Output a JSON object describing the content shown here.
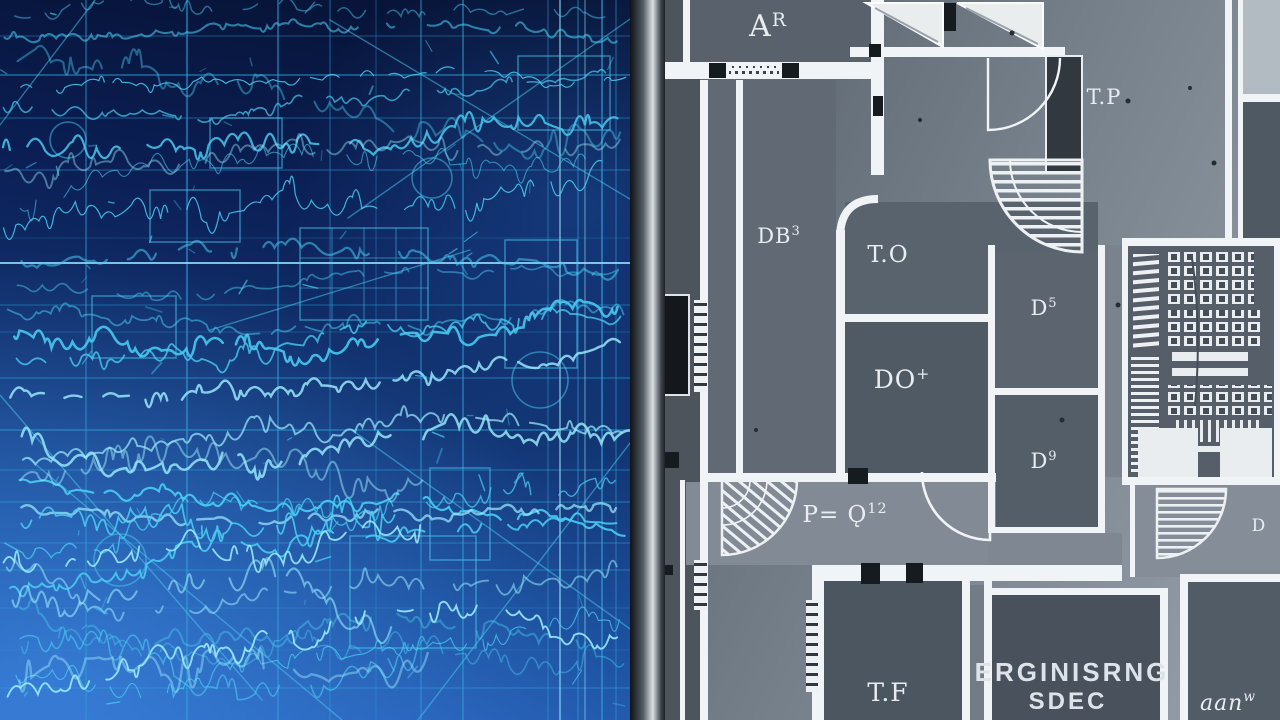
{
  "floorplan": {
    "labels": [
      {
        "text": "A",
        "sup": "R",
        "x": 768,
        "y": 36,
        "size": 30
      },
      {
        "text": "T.P",
        "sup": "",
        "x": 1104,
        "y": 104,
        "size": 21
      },
      {
        "text": "DB",
        "sup": "3",
        "x": 779,
        "y": 243,
        "size": 21
      },
      {
        "text": "T.O",
        "sup": "",
        "x": 888,
        "y": 262,
        "size": 23
      },
      {
        "text": "DO",
        "sup": "+",
        "x": 902,
        "y": 388,
        "size": 25
      },
      {
        "text": "D",
        "sup": "5",
        "x": 1044,
        "y": 315,
        "size": 21
      },
      {
        "text": "D",
        "sup": "9",
        "x": 1044,
        "y": 468,
        "size": 21
      },
      {
        "text": "P= Ǫ",
        "sup": "12",
        "x": 845,
        "y": 522,
        "size": 23
      },
      {
        "text": "T.F",
        "sup": "",
        "x": 888,
        "y": 701,
        "size": 25
      },
      {
        "text": "D",
        "sup": "",
        "x": 1259,
        "y": 531,
        "size": 17
      },
      {
        "text": "aan",
        "sup": "w",
        "x": 1228,
        "y": 710,
        "size": 22
      }
    ],
    "spec_label": {
      "line1": "ERGINISRNG",
      "line2": "SDEC"
    }
  },
  "colors": {
    "blueprint_ink": "#49cdf4",
    "blueprint_ink_bright": "#9aeafd",
    "blueprint_grid": "#2f9fd8",
    "plan_wall": "#f1f4f7",
    "plan_room_dark": "#4e5862",
    "window_symbol": "#161b20",
    "label_ink": "#e9edf2"
  }
}
